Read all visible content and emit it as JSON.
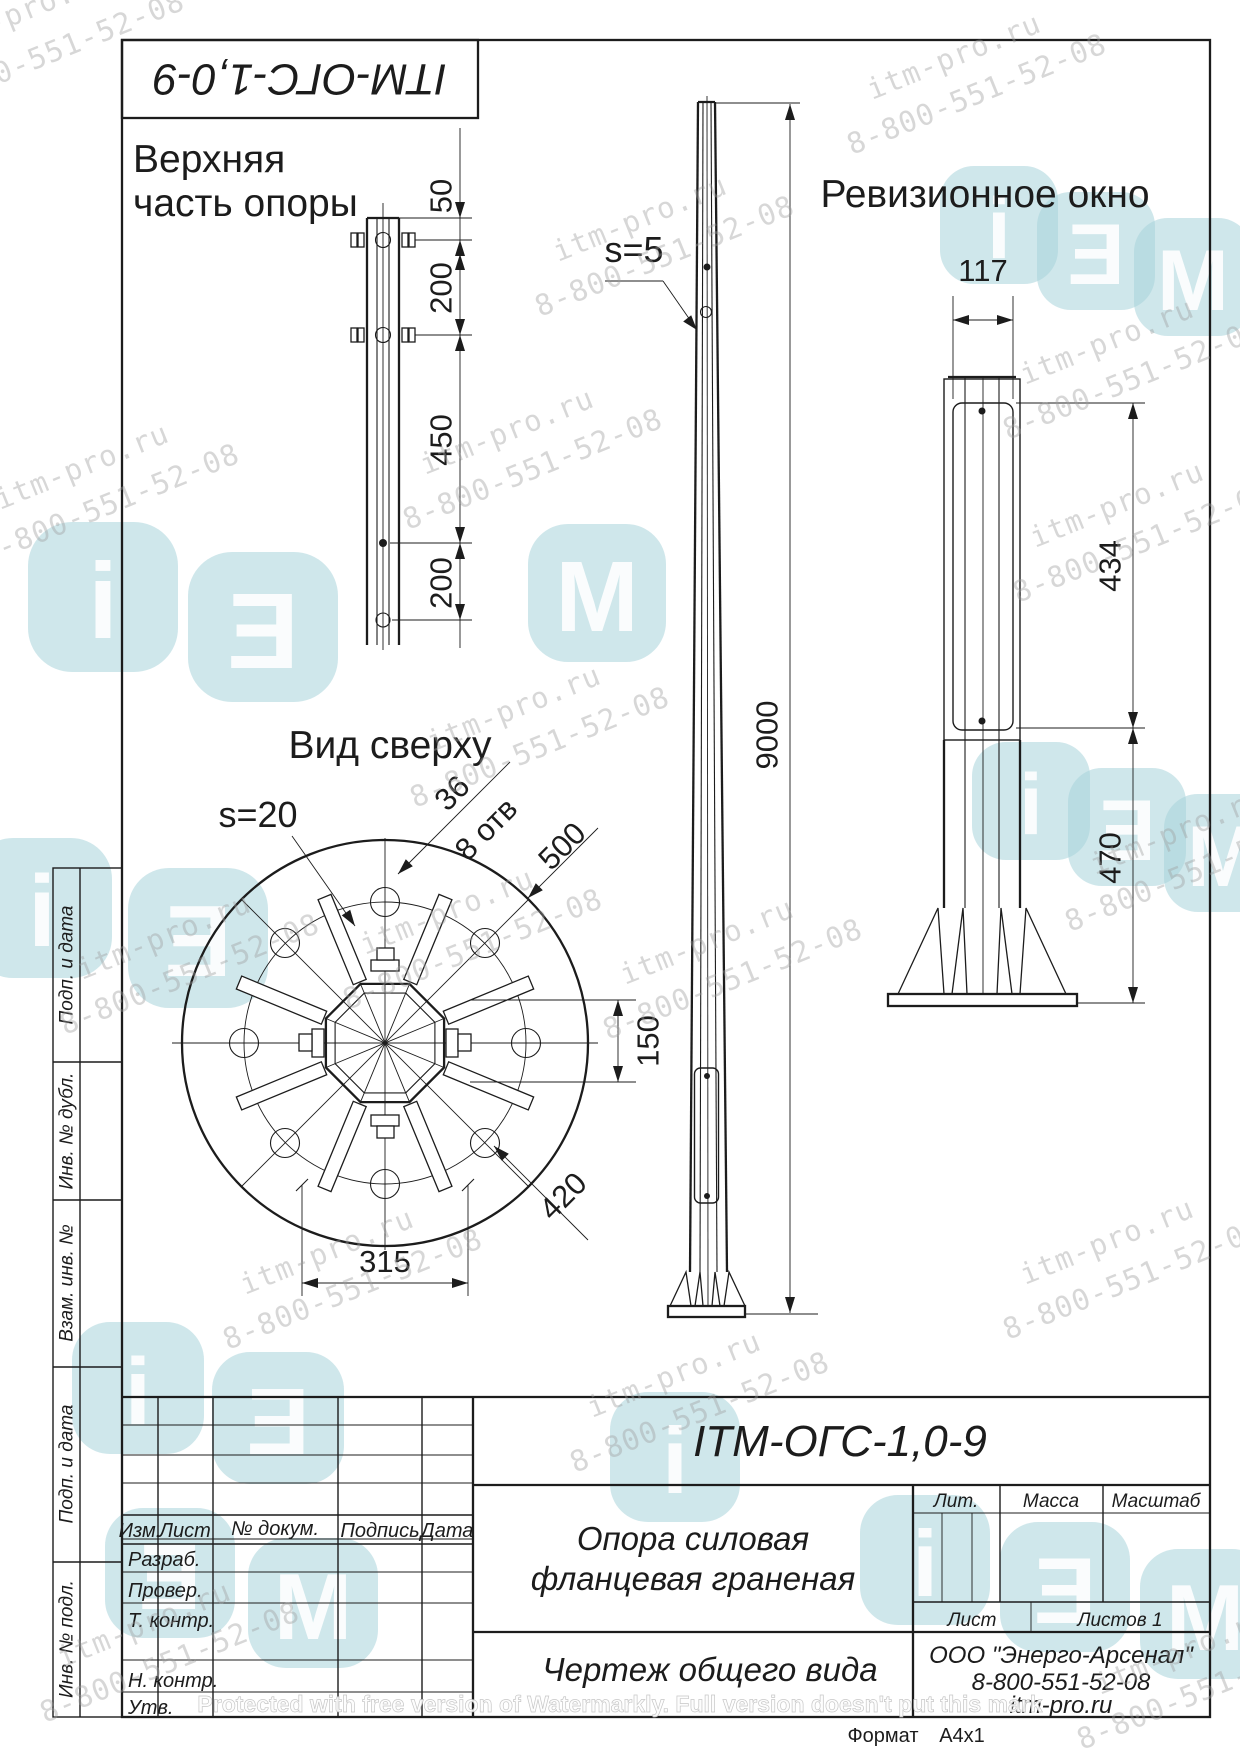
{
  "page": {
    "format_label": "Формат",
    "format_value": "A4x1"
  },
  "designation": "ITM-ОГС-1,0-9",
  "views": {
    "top_detail": {
      "title1": "Верхняя",
      "title2": "часть опоры",
      "dim_50": "50",
      "dim_200a": "200",
      "dim_450": "450",
      "dim_200b": "200"
    },
    "front": {
      "s_label": "s=5",
      "height": "9000"
    },
    "plan": {
      "title": "Вид сверху",
      "s_label": "s=20",
      "hole_dia": "36",
      "holes_count": "8 отв",
      "outer_dia": "500",
      "bolt_circle": "420",
      "width": "315",
      "across": "150"
    },
    "side": {
      "title": "Ревизионное окно",
      "window_width": "117",
      "window_height": "434",
      "bottom_offset": "470"
    }
  },
  "side_stamps": [
    "Подп. и дата",
    "Инв. № дубл.",
    "Взам. инв. №",
    "Подп. и дата",
    "Инв. № подл."
  ],
  "title_block": {
    "header": {
      "izm": "Изм.",
      "list": "Лист",
      "doc": "№ докум.",
      "sign": "Подпись",
      "date": "Дата"
    },
    "roles": [
      "Разраб.",
      "Провер.",
      "Т. контр.",
      "Н. контр.",
      "Утв."
    ],
    "name1": "Опора силовая",
    "name2": "фланцевая граненая",
    "doc_type": "Чертеж общего вида",
    "lit": "Лит.",
    "mass": "Масса",
    "scale": "Масштаб",
    "sheet": "Лист",
    "sheets": "Листов 1",
    "company1": "ООО \"Энерго-Арсенал\"",
    "company2": "8-800-551-52-08",
    "company3": "itm-pro.ru"
  },
  "watermark": {
    "site": "itm-pro.ru",
    "phone": "8-800-551-52-08",
    "letters": [
      "i",
      "Ǝ",
      "M"
    ],
    "protect": "Protected with free version of Watermarkly. Full version doesn't put this mark",
    "logo_color": "#a7d3db"
  }
}
